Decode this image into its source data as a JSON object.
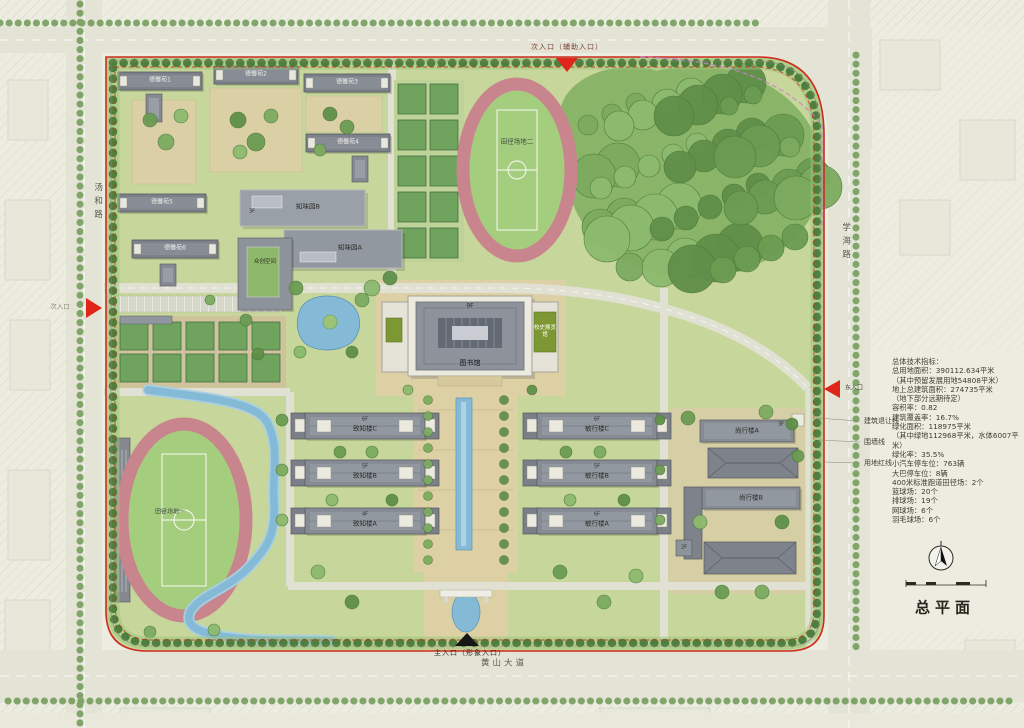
{
  "map_title": "总平面",
  "roads": {
    "west": "汤和路",
    "east": "学海路",
    "south": "黄山大道"
  },
  "entrances": {
    "north": "次入口（辅助入口）",
    "west": "次入口",
    "east": "东入口",
    "south": "主入口（形象入口）"
  },
  "boundary_legend": {
    "setback_line": "建筑退让线",
    "wall_line": "围墙线",
    "red_line": "用地红线"
  },
  "indicators": {
    "heading": "总体技术指标：",
    "lines": [
      "总用地面积：390112.634平米",
      "（其中预留发展用地54808平米）",
      "地上总建筑面积：274735平米",
      "（地下部分远期待定）",
      "容积率：0.82",
      "建筑覆盖率：16.7%",
      "绿化面积：118975平米",
      "（其中绿地112968平米，水体6007平米）",
      "绿化率：35.5%",
      "小汽车停车位：763辆",
      "大巴停车位：8辆",
      "400米标准跑道田径场：2个",
      "篮球场：20个",
      "排球场：19个",
      "网球场：6个",
      "羽毛球场：6个"
    ]
  },
  "buildings": {
    "dorms": [
      "德馨苑1",
      "德馨苑2",
      "德馨苑3",
      "德馨苑4",
      "德馨苑5",
      "德馨苑6"
    ],
    "canteen_b": "知味园B",
    "canteen_b_floor": "3F",
    "canteen_a": "知味园A",
    "maker_space": "众创空间",
    "library": "图书馆",
    "library_floor": "9F",
    "history_hall": "校史展览馆",
    "teach_left": [
      {
        "label": "致知楼C",
        "floor": "6F"
      },
      {
        "label": "致知楼B",
        "floor": "5F"
      },
      {
        "label": "致知楼A",
        "floor": "4F"
      }
    ],
    "teach_right": [
      {
        "label": "敏行楼C",
        "floor": "6F"
      },
      {
        "label": "敏行楼B",
        "floor": "5F"
      },
      {
        "label": "敏行楼A",
        "floor": "6F"
      }
    ],
    "shangxing_a": "尚行楼A",
    "shangxing_a_floor": "3F",
    "shangxing_b": "尚行楼B",
    "shangxing_b_floor": "2F"
  },
  "fields": {
    "track_west": "田径场地一",
    "track_north": "田径场地二"
  },
  "colors": {
    "red_line": "#cf2b20",
    "water": "#85bad7",
    "track": "#c9858d",
    "accent_green": "#7d9732"
  }
}
